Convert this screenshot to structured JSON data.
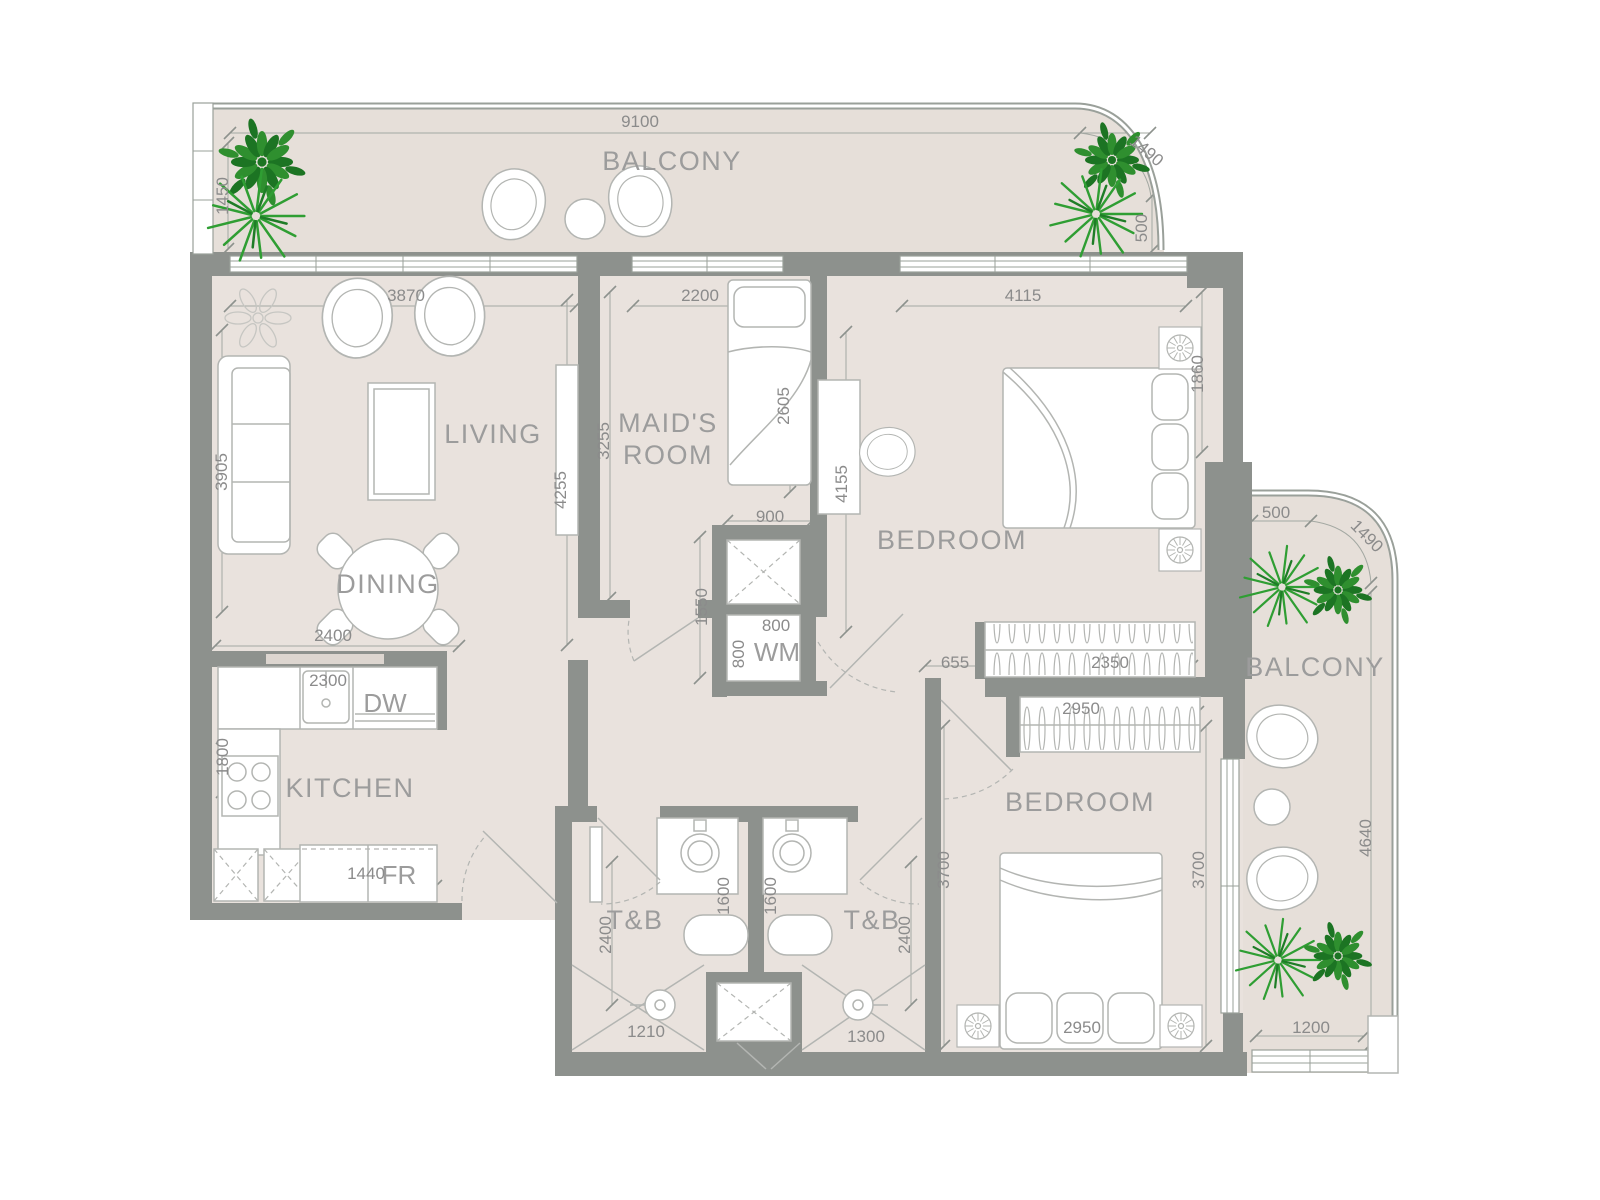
{
  "rooms": {
    "balcony_top": "BALCONY",
    "living": "LIVING",
    "dining": "DINING",
    "kitchen": "KITCHEN",
    "maids_line1": "MAID'S",
    "maids_line2": "ROOM",
    "bedroom_top": "BEDROOM",
    "bedroom_bottom": "BEDROOM",
    "balcony_right": "BALCONY",
    "tb_left": "T&B",
    "tb_right": "T&B"
  },
  "appliances": {
    "dw": "DW",
    "wm": "WM",
    "fr": "FR"
  },
  "dimensions": {
    "balcony_top_width": "9100",
    "balcony_top_left": "1450",
    "balcony_top_right": "500",
    "balcony_top_curve": "1490",
    "living_window": "3870",
    "living_depth": "3905",
    "living_wall": "4255",
    "dining_width": "2400",
    "maids_window": "2200",
    "maids_depth": "3255",
    "maids_bed": "2605",
    "shaft_width": "900",
    "hall_width": "1550",
    "wm_width": "800",
    "wm_depth": "800",
    "bedroom_top_window": "4115",
    "bedroom_top_bed_wall": "1860",
    "bedroom_top_depth": "4155",
    "bedroom_top_door_offset": "655",
    "wardrobe_top": "2350",
    "wardrobe_bottom": "2950",
    "kitchen_counter": "2300",
    "kitchen_side": "1800",
    "fridge_width": "1440",
    "tb_left_depth": "2400",
    "tb_left_vanity": "1600",
    "tb_right_vanity": "1600",
    "tb_right_depth": "2400",
    "shower_left": "1210",
    "shower_right": "1300",
    "bedroom_bottom_depth_left": "3700",
    "bedroom_bottom_depth_right": "3700",
    "bedroom_bottom_bed": "2950",
    "balcony_right_top": "500",
    "balcony_right_curve": "1490",
    "balcony_right_depth": "4640",
    "balcony_right_bottom": "1200"
  },
  "colors": {
    "floor": "#e9e2dd",
    "balcony_floor": "#e6dfd9",
    "wall": "#8d918d",
    "label_text": "#9c9c9c",
    "dimension_text": "#8b8b8b",
    "plant_green": "#2f9e33",
    "plant_dark_green": "#1c7423"
  }
}
